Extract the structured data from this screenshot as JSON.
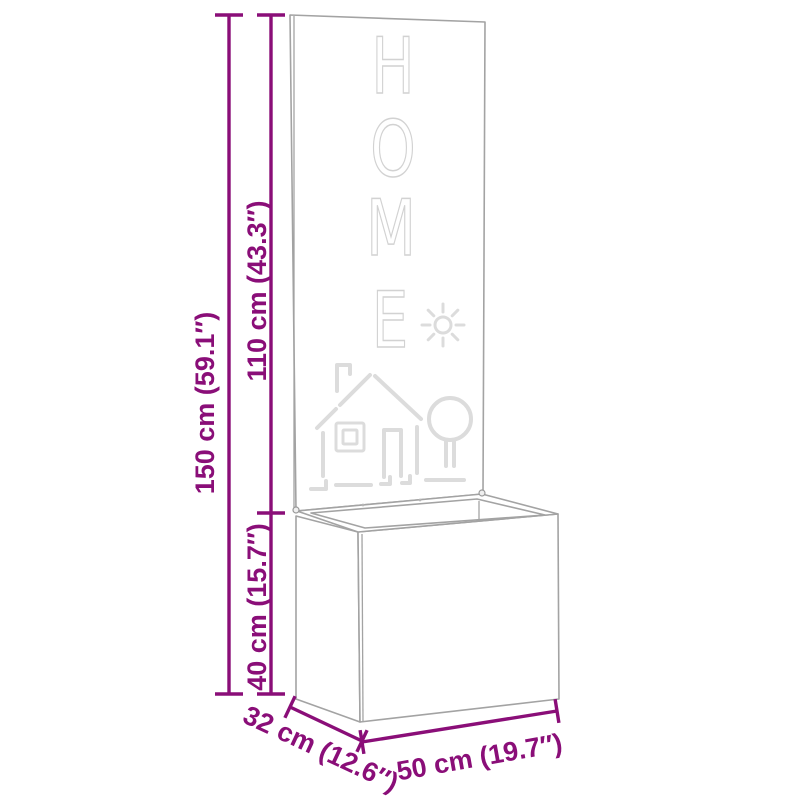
{
  "colors": {
    "accent": "#8a0e78",
    "edge": "#a3a3a3",
    "cutout": "#d2d2d2",
    "deco": "#dcdcdc"
  },
  "product": {
    "panel_word": "HOME",
    "panel_letters": [
      "H",
      "O",
      "M",
      "E"
    ],
    "panel_icons": [
      "sun-icon",
      "house-icon",
      "tree-icon"
    ]
  },
  "dimensions": {
    "total_height": "150 cm (59.1″)",
    "panel_height": "110 cm (43.3″)",
    "box_height": "40 cm (15.7″)",
    "depth": "32 cm (12.6″)",
    "width": "50 cm (19.7″)"
  }
}
